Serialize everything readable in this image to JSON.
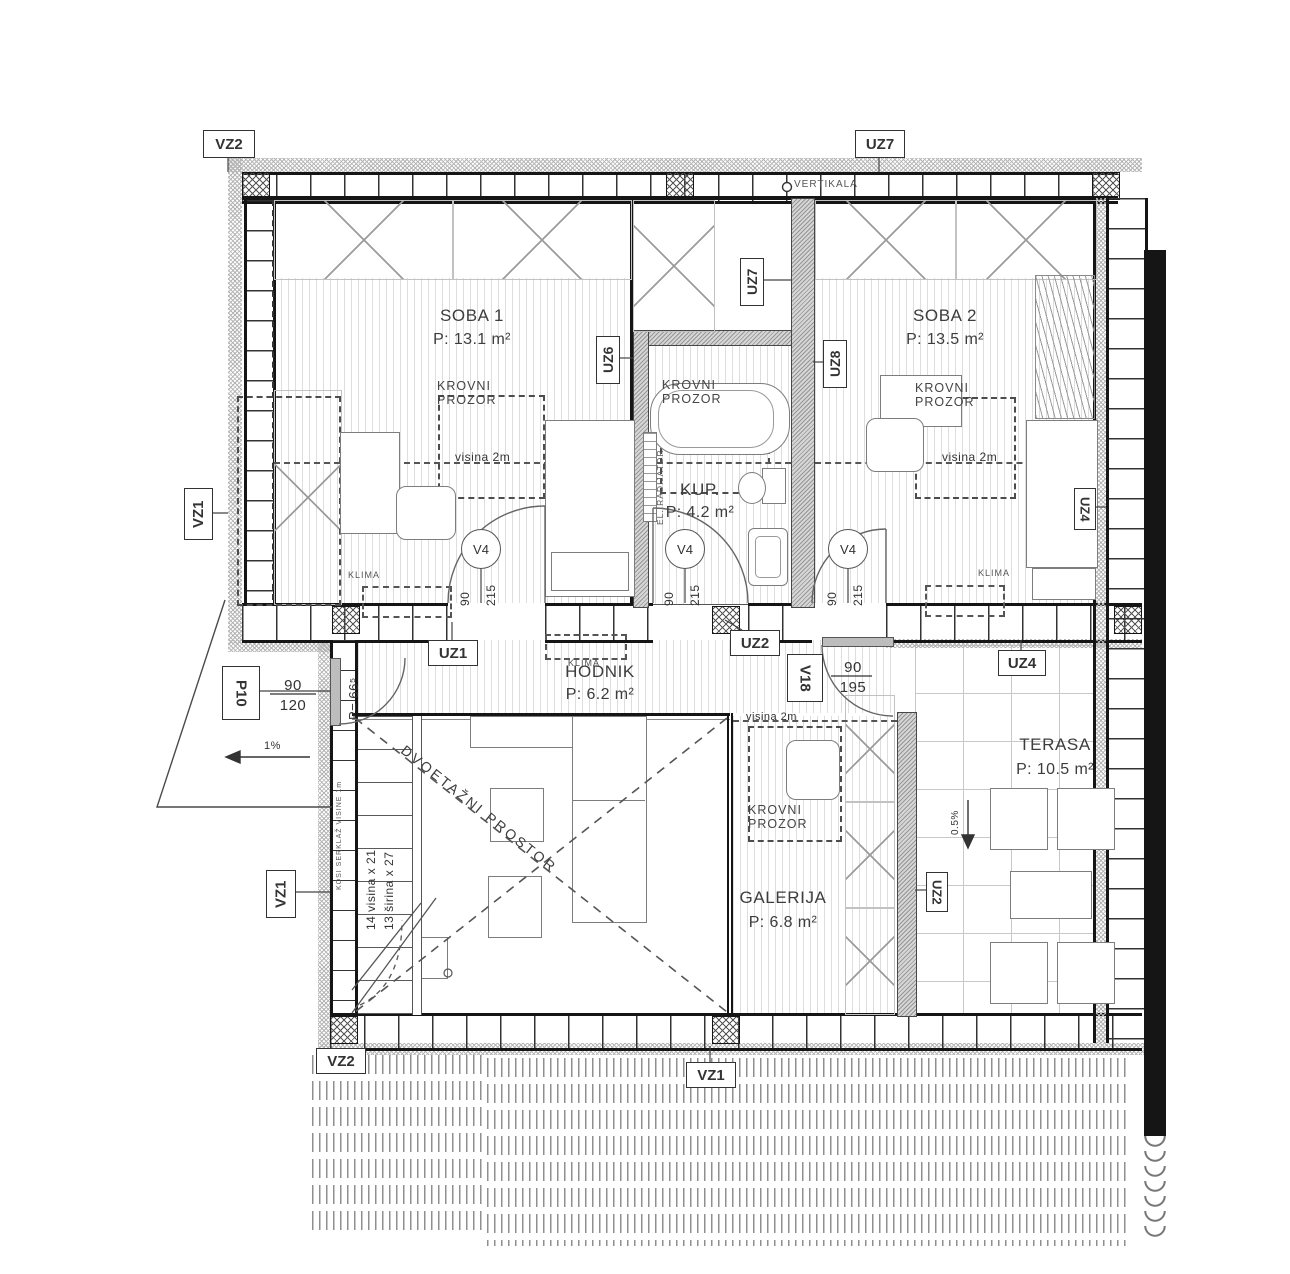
{
  "plan": {
    "rooms": {
      "soba1": {
        "name": "SOBA 1",
        "area": "P: 13.1 m²"
      },
      "soba2": {
        "name": "SOBA 2",
        "area": "P: 13.5 m²"
      },
      "kup": {
        "name": "KUP.",
        "area": "P: 4.2 m²"
      },
      "hodnik": {
        "name": "HODNIK",
        "area": "P: 6.2 m²"
      },
      "galerija": {
        "name": "GALERIJA",
        "area": "P: 6.8 m²"
      },
      "terasa": {
        "name": "TERASA",
        "area": "P: 10.5 m²"
      }
    },
    "tags": {
      "vz2_top": "VZ2",
      "uz7_top": "UZ7",
      "vz1_upper_left": "VZ1",
      "uz6": "UZ6",
      "uz7_wall": "UZ7",
      "uz8": "UZ8",
      "uz1": "UZ1",
      "uz2_hall": "UZ2",
      "uz4_bed": "UZ4",
      "uz4_terrace": "UZ4",
      "uz2_terrace": "UZ2",
      "vz1_lower_left": "VZ1",
      "vz2_bottom": "VZ2",
      "vz1_bottom": "VZ1",
      "p10": "P10",
      "v18": "V18",
      "v4": "V4"
    },
    "dims": {
      "v4_w": "90",
      "v4_h": "215",
      "v18_w": "90",
      "v18_h": "195",
      "p10_w": "90",
      "p10_h": "120"
    },
    "notes": {
      "vertikala": "VERTIKALA",
      "krovni_prozor": "KROVNI PROZOR",
      "visina_2m": "visina 2m",
      "klima": "KLIMA",
      "el_radijator": "EL. RADIJATOR",
      "dvoetazni_prostor": "DVOETAŽNI PROSTOR",
      "stair_rise": "14 visina x 21",
      "stair_run": "13 širina x 27",
      "kosi_serklaz": "KOSI SERKLAŽ VISINE 1m",
      "p66": "P= 66⁵",
      "slope_1": "1%",
      "slope_05": "0.5%"
    },
    "colors": {
      "line": "#1a1a1a",
      "hatch": "#b5b5b5",
      "text": "#3d3d3d"
    }
  }
}
